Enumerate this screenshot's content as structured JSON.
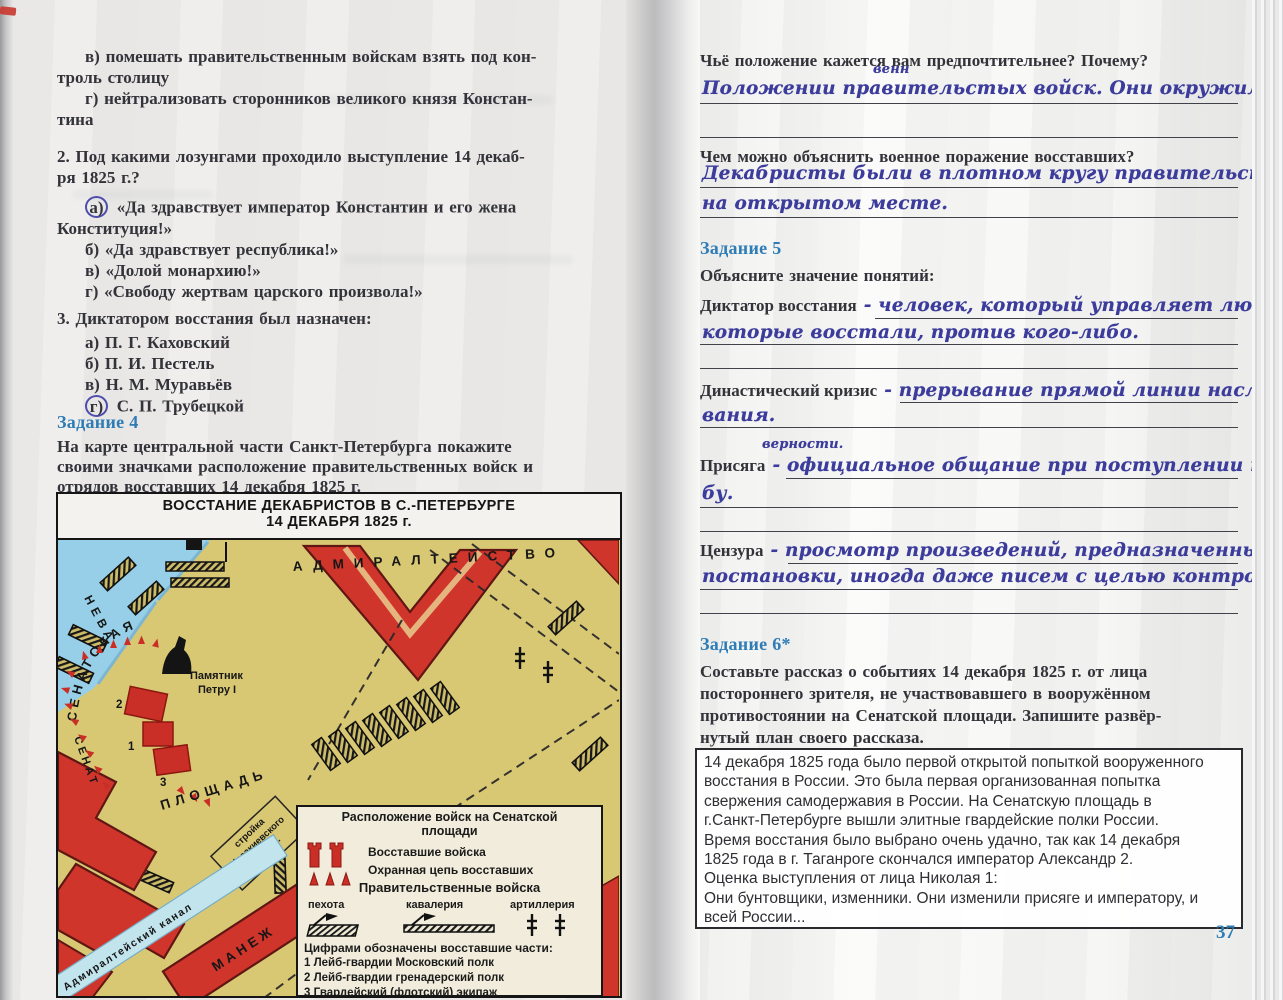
{
  "left": {
    "q1": {
      "v1": "в) помешать правительственным войскам взять под кон-",
      "v2": "троль столицу",
      "g1": "г) нейтрализовать сторонников великого князя Констан-",
      "g2": "тина"
    },
    "q2": {
      "t1": "2. Под какими лозунгами проходило выступление 14 декаб-",
      "t2": "ря 1825 г.?",
      "a_letter": "а)",
      "a1": "«Да здравствует император Константин и его жена",
      "a2": "Конституция!»",
      "b": "б) «Да здравствует республика!»",
      "c": "в) «Долой монархию!»",
      "d": "г) «Свободу жертвам царского произвола!»"
    },
    "q3": {
      "t": "3. Диктатором восстания был назначен:",
      "a": "а) П. Г. Каховский",
      "b": "б) П. И. Пестель",
      "c": "в) Н. М. Муравьёв",
      "d_letter": "г)",
      "d": "С. П. Трубецкой"
    },
    "task4": {
      "heading": "Задание 4",
      "p1": "На карте центральной части Санкт-Петербурга покажите",
      "p2": "своими значками расположение правительственных войск и",
      "p3": "отрядов восставших 14 декабря 1825 г."
    },
    "map": {
      "title1": "ВОССТАНИЕ ДЕКАБРИСТОВ В С.-ПЕТЕРБУРГЕ",
      "title2": "14 ДЕКАБРЯ 1825 г.",
      "labels": {
        "neva": "НЕВА",
        "admiralty": "АДМИРАЛТЕЙСТВО",
        "senatskaya": "СЕНАТСКАЯ",
        "senat": "СЕНАТ",
        "monument1": "Памятник",
        "monument2": "Петру I",
        "square": "ПЛОЩАДЬ",
        "construction1": "стройка",
        "construction2": "Исаакиевского",
        "construction3": "собора.",
        "canal": "Адмиралтейский канал",
        "manege": "МАНЕЖ",
        "num1": "1",
        "num2": "2",
        "num3": "3"
      },
      "legend": {
        "title1": "Расположение войск на Сенатской",
        "title2": "площади",
        "rebel": "Восставшие войска",
        "chain": "Охранная цепь восставших",
        "gov": "Правительственные войска",
        "infantry": "пехота",
        "cavalry": "кавалерия",
        "artillery": "артиллерия",
        "note": "Цифрами обозначены восставшие части:",
        "unit1": "1 Лейб-гвардии Московский полк",
        "unit2": "2 Лейб-гвардии гренадерский полк",
        "unit3": "3 Гвардейский (флотский) экипаж"
      }
    }
  },
  "right": {
    "q_position": "Чьё положение кажется вам предпочтительнее? Почему?",
    "ans_position": {
      "before": "Положении правительст",
      "above": "венн",
      "after": "ых войск. Они окружили декабристов"
    },
    "q_defeat": "Чем можно объяснить военное поражение восставших?",
    "ans_defeat1": "Декабристы были в плотном кругу правительственных войск",
    "ans_defeat2": "на открытом месте.",
    "task5": {
      "heading": "Задание 5",
      "subtitle": "Объясните значение понятий:"
    },
    "terms": [
      {
        "label": "Диктатор восстания",
        "hand1": "- человек, который управляет людьми,",
        "hand2": "которые восстали, против кого-либо."
      },
      {
        "label": "Династический кризис",
        "hand1": "- прерывание прямой линии наследо-",
        "hand2": "вания."
      },
      {
        "label": "Присяга",
        "above": "верности.",
        "hand1": "- официальное общание при поступлении на служ-",
        "hand2": "бу."
      },
      {
        "label": "Цензура",
        "hand1": "- просмотр произведений, предназначенных для печати,",
        "hand2": "постановки, иногда даже писем с целью контроля."
      }
    ],
    "task6": {
      "heading": "Задание 6*",
      "p1": "Составьте рассказ о событиях 14 декабря 1825 г. от лица",
      "p2": "постороннего зрителя, не участвовавшего в вооружённом",
      "p3": "противостоянии на Сенатской площади. Запишите развёр-",
      "p4": "нутый план своего рассказа."
    },
    "typed_answer": {
      "lines": [
        "14 декабря 1825 года было первой открытой попыткой вооруженного",
        "восстания в России. Это была первая организованная попытка",
        "свержения самодержавия в России. На Сенатскую площадь в",
        "г.Санкт-Петербурге вышли элитные гвардейские полки России.",
        "Время восстания было выбрано очень удачно, так как 14 декабря",
        "1825 года в г. Таганроге скончался император Александр 2.",
        "Оценка выступления от лица Николая 1:",
        "Они бунтовщики, изменники. Они изменили присяге и императору, и",
        "всей России..."
      ]
    },
    "page_number": "37"
  },
  "colors": {
    "accent_blue": "#2d7cb6",
    "hand_ink": "#3c3c9c",
    "map_red": "#d0352b",
    "map_tan": "#d9c873",
    "water_blue": "#96cfe7"
  }
}
